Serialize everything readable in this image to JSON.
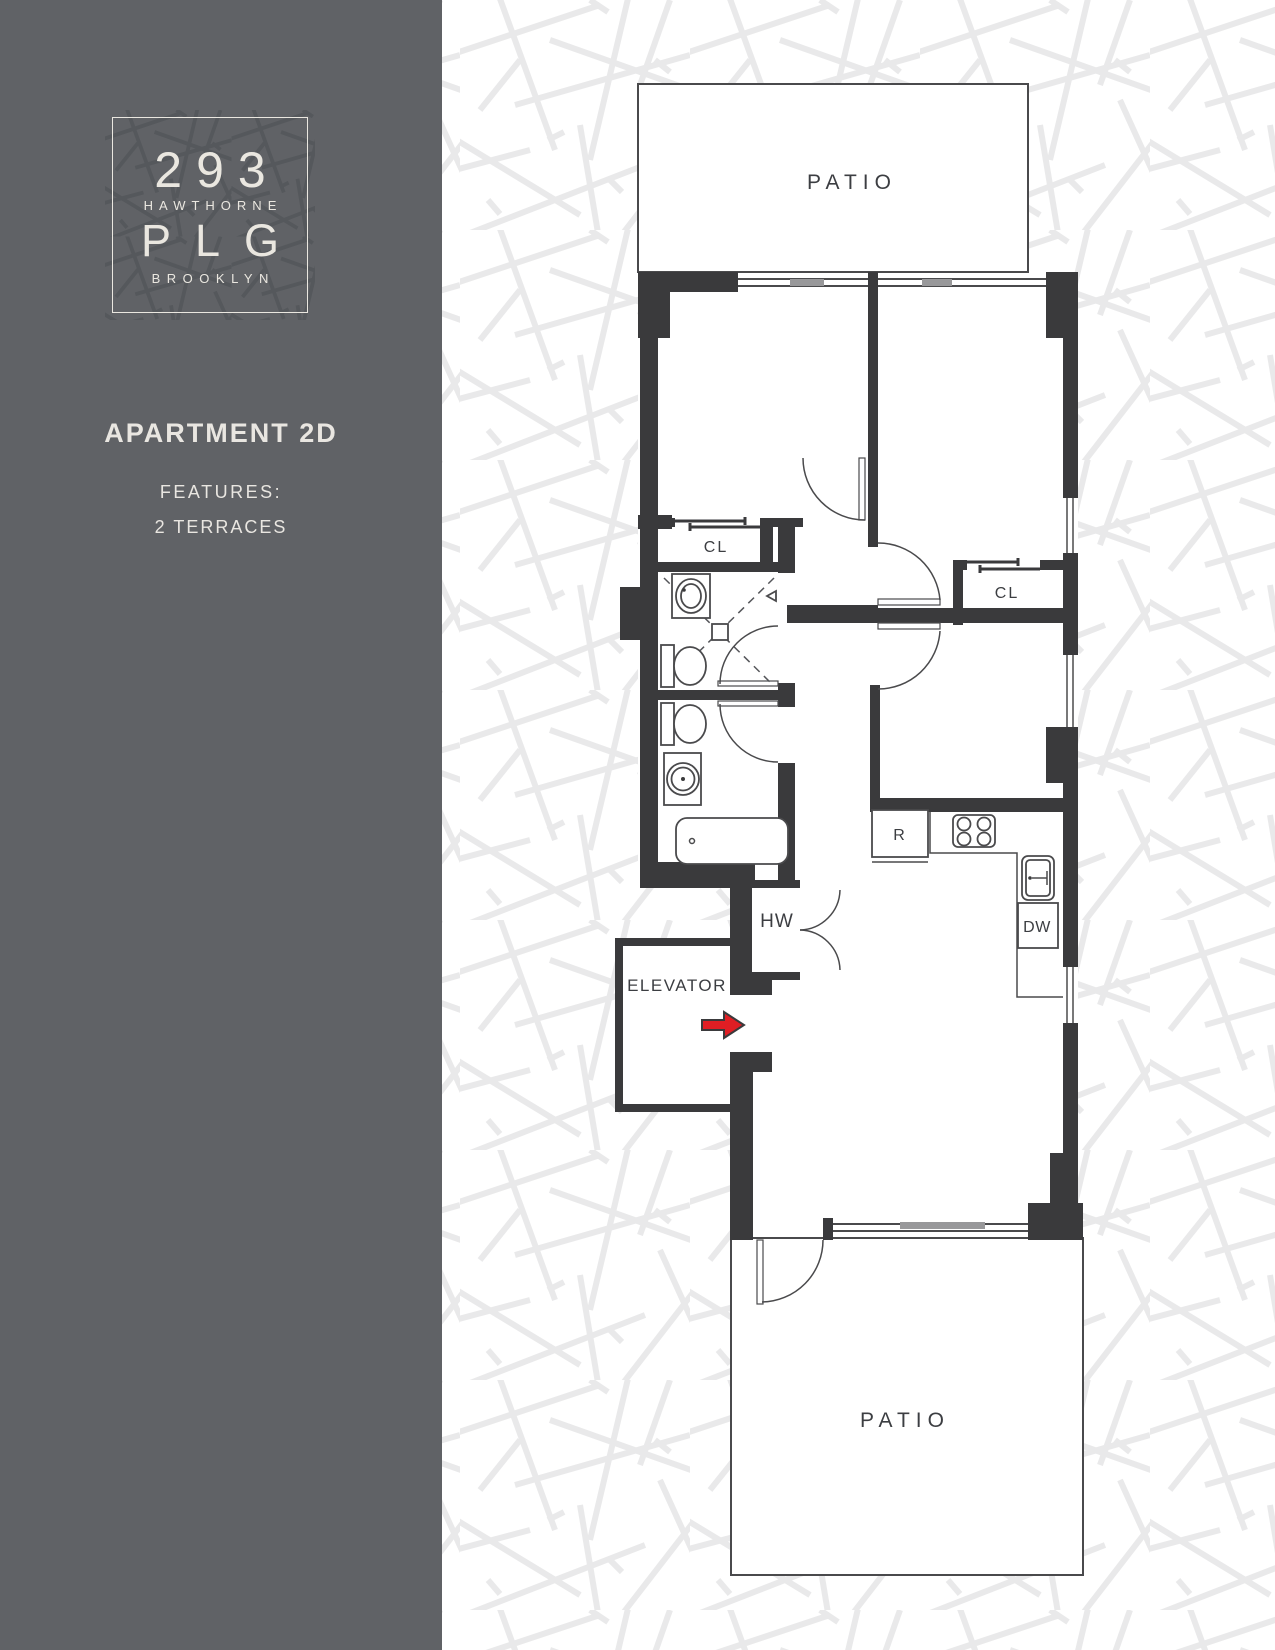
{
  "sidebar": {
    "logo": {
      "number": "293",
      "street": "HAWTHORNE",
      "neighborhood": "PLG",
      "borough": "BROOKLYN"
    },
    "apartment_title": "APARTMENT 2D",
    "features_heading": "FEATURES:",
    "features_item": "2 TERRACES"
  },
  "floorplan": {
    "patio_top": "PATIO",
    "patio_bottom": "PATIO",
    "closet_left": "CL",
    "closet_right": "CL",
    "hot_water": "HW",
    "elevator": "ELEVATOR",
    "refrigerator": "R",
    "dishwasher": "DW"
  },
  "colors": {
    "sidebar_background": "#606266",
    "logo_cream": "#eae7e0",
    "wall_dark": "#3a3a3c",
    "entry_arrow_red": "#e01e24",
    "background_pattern_line": "#e9e9ea",
    "logo_pattern_line": "#55585c",
    "window_glass_gray": "#98989a"
  }
}
